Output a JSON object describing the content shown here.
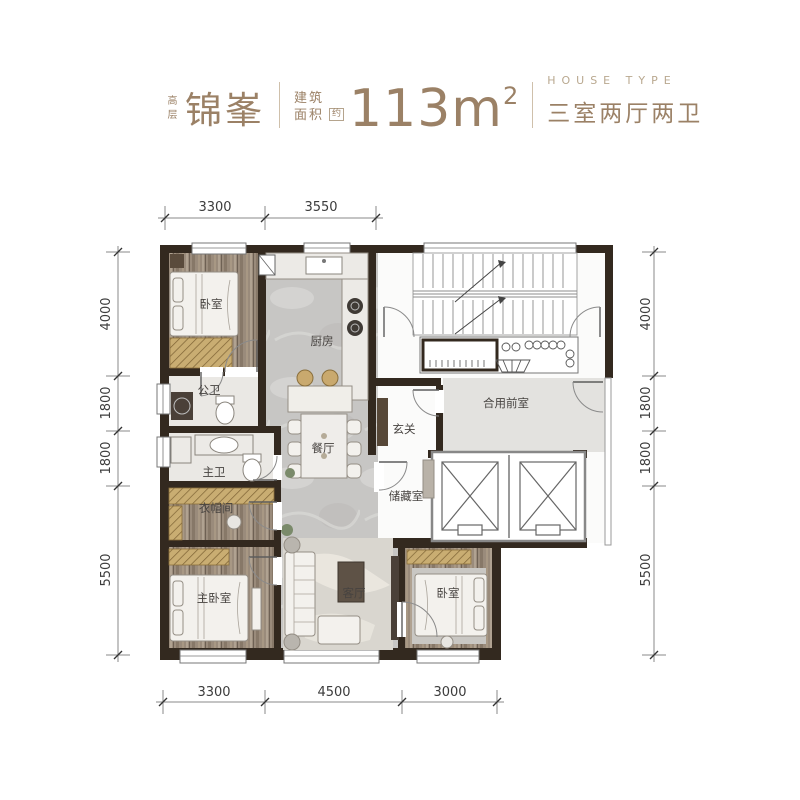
{
  "header": {
    "tier": "高层",
    "name": "锦峯",
    "area_label_line1": "建筑",
    "area_label_line2": "面积",
    "area_qualifier": "约",
    "area_value": "113m",
    "area_exponent": "2",
    "house_type_en": "HOUSE TYPE",
    "house_type_cn": "三室两厅两卫"
  },
  "plan": {
    "rooms": {
      "bedroom_top": "卧室",
      "kitchen": "厨房",
      "guest_bathroom": "公卫",
      "master_bathroom": "主卫",
      "cloakroom": "衣帽间",
      "master_bedroom": "主卧室",
      "dining_room": "餐厅",
      "living_room": "客厅",
      "foyer": "玄关",
      "storage_room": "储藏室",
      "bedroom_right": "卧室",
      "shared_lobby": "合用前室"
    },
    "dimensions": {
      "top": [
        "3300",
        "3550"
      ],
      "bottom": [
        "3300",
        "4500",
        "3000"
      ],
      "left": [
        "4000",
        "1800",
        "1800",
        "5500"
      ],
      "right": [
        "4000",
        "1800",
        "1800",
        "5500"
      ]
    }
  },
  "colors": {
    "accent": "#9b8166",
    "wall": "#33291f",
    "wood_floor": "#9a8b7b",
    "stone_floor": "#c7c6c4",
    "gold_accent": "#c9ad72"
  }
}
